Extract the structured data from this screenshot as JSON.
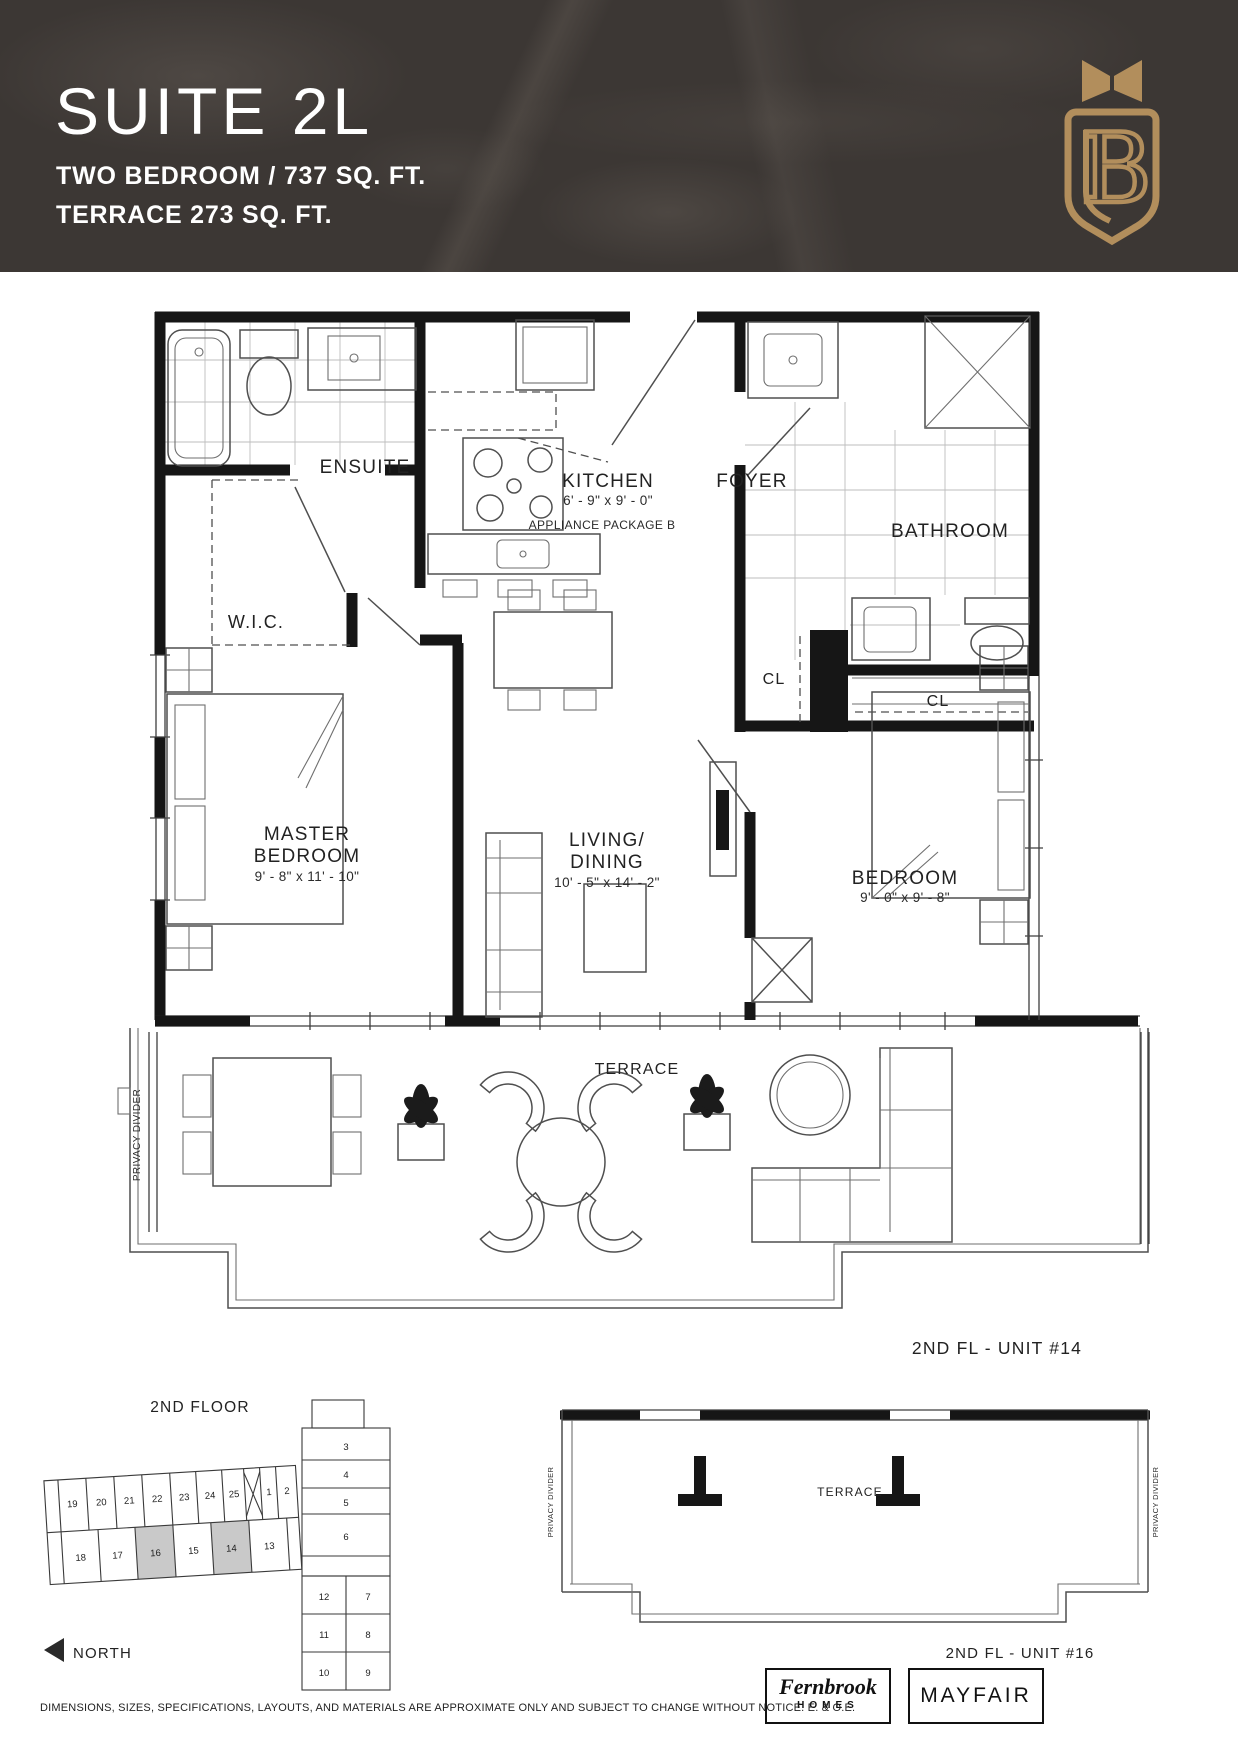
{
  "header": {
    "suite_title": "SUITE 2L",
    "subtitle_line1": "TWO BEDROOM  / 737 SQ. FT.",
    "subtitle_line2": "TERRACE 273 SQ. FT.",
    "brand_letter": "B",
    "colors": {
      "banner_bg": "#3c3734",
      "gold": "#b28e5c",
      "title_text": "#ffffff"
    }
  },
  "floorplan": {
    "rooms": {
      "ensuite": {
        "label": "ENSUITE"
      },
      "wic": {
        "label": "W.I.C."
      },
      "kitchen": {
        "label": "KITCHEN",
        "dimensions": "6' - 9\" x 9' - 0\"",
        "note": "APPLIANCE PACKAGE B"
      },
      "foyer": {
        "label": "FOYER"
      },
      "bathroom": {
        "label": "BATHROOM"
      },
      "closet1": {
        "label": "CL"
      },
      "closet2": {
        "label": "CL"
      },
      "master_bedroom": {
        "label_line1": "MASTER",
        "label_line2": "BEDROOM",
        "dimensions": "9' - 8\" x 11' - 10\""
      },
      "living_dining": {
        "label_line1": "LIVING/",
        "label_line2": "DINING",
        "dimensions": "10' - 5\" x 14' - 2\""
      },
      "bedroom": {
        "label": "BEDROOM",
        "dimensions": "9' - 0\" x 9' - 8\""
      },
      "terrace": {
        "label": "TERRACE"
      }
    },
    "privacy_divider": "PRIVACY DIVIDER",
    "unit_label": "2ND FL - UNIT #14"
  },
  "keyplan": {
    "title": "2ND FLOOR",
    "north_label": "NORTH",
    "highlighted_units": [
      "16",
      "14"
    ],
    "units": [
      "19",
      "20",
      "21",
      "22",
      "23",
      "24",
      "25",
      "1",
      "2",
      "18",
      "17",
      "16",
      "15",
      "14",
      "13",
      "3",
      "4",
      "5",
      "6",
      "12",
      "7",
      "11",
      "8",
      "10",
      "9"
    ]
  },
  "terrace_plan": {
    "terrace_label": "TERRACE",
    "privacy_divider_left": "PRIVACY DIVIDER",
    "privacy_divider_right": "PRIVACY DIVIDER",
    "unit_label": "2ND FL - UNIT #16"
  },
  "footer": {
    "logo_fernbrook_line1": "Fernbrook",
    "logo_fernbrook_line2": "HOMES",
    "logo_mayfair": "MAYFAIR",
    "disclaimer": "DIMENSIONS, SIZES, SPECIFICATIONS, LAYOUTS, AND MATERIALS ARE APPROXIMATE ONLY AND SUBJECT TO CHANGE WITHOUT NOTICE. E. & O.E."
  }
}
